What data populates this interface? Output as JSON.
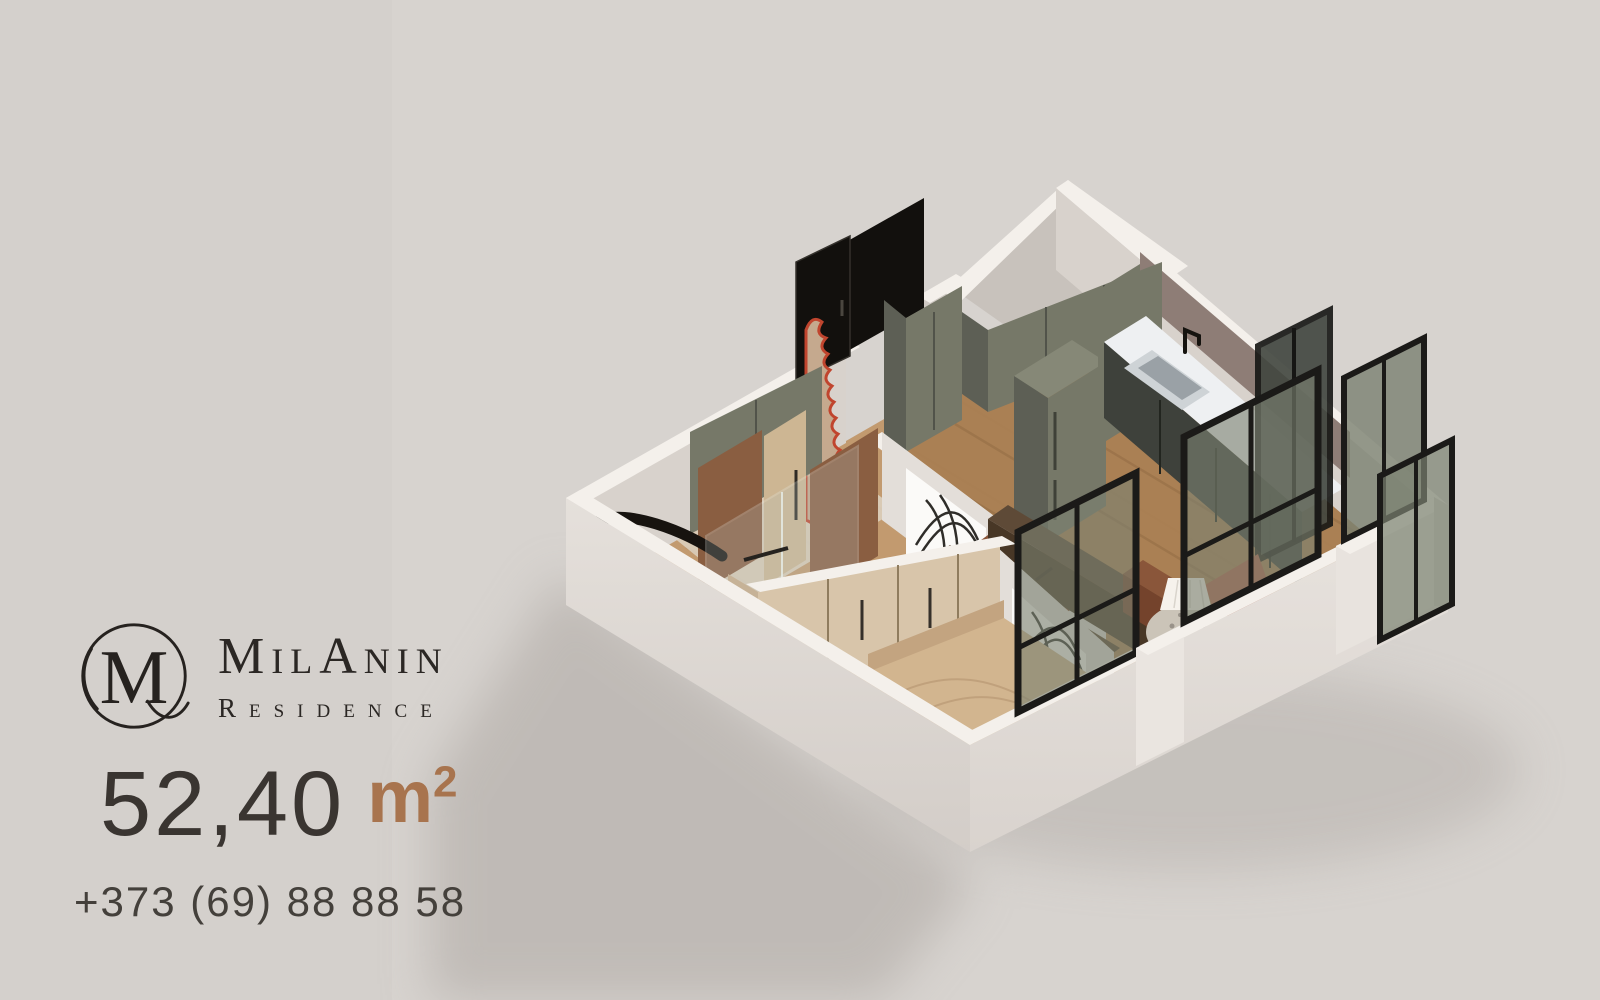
{
  "brand": {
    "logo_letter": "M",
    "name": "MilAnin",
    "subtitle": "Residence"
  },
  "listing": {
    "area_value": "52,40",
    "area_unit_letter": "m",
    "area_unit_sup": "2",
    "phone": "+373 (69) 88 88 58"
  },
  "scene": {
    "type": "isometric-3d-floor-plan",
    "description": "Cutaway 3D isometric render of a 52.40 m2 one-bedroom apartment",
    "rooms": [
      "hallway",
      "bathroom",
      "shower-room",
      "bedroom",
      "living-room",
      "kitchen"
    ],
    "objects": [
      "entrance-door",
      "wavy-mirror",
      "entry-closets",
      "pantry-cabinet",
      "fridge",
      "kitchen-counter-with-sink",
      "botanical-wall-art",
      "tv-console",
      "sofa",
      "floor-lamp",
      "terrazzo-coffee-table",
      "armchair",
      "wardrobe",
      "bed",
      "bathtub",
      "shower-glass",
      "parapet-windows",
      "balcony-windows"
    ]
  },
  "palette": {
    "bg_left": "#d4d0cc",
    "bg_right": "#d7d3cf",
    "shadow": "#a9a39e",
    "wall_top": "#f4f0eb",
    "wall_face": "#e3ded9",
    "wall_face_dark": "#cfc9c3",
    "wall_inner": "#d8d2cc",
    "floor_light": "#c29a6f",
    "floor_dark": "#a87e52",
    "plank_light": "#a37b50",
    "plank_dark": "#8a643f",
    "bath_floor": "#ddd2c2",
    "olive": "#767868",
    "olive_dark": "#5d5f55",
    "olive_light": "#868877",
    "counter_top": "#eef0f2",
    "counter_base": "#3e413b",
    "backsplash": "#8e7d76",
    "sink_steel": "#ced3d6",
    "sink_basin": "#9aa1a6",
    "wood_dark": "#74432c",
    "wood_mid": "#8a563a",
    "sofa": "#57432f",
    "sofa_dark": "#483726",
    "sofa_back": "#5e4a37",
    "table_terrazzo": "#cbc4b8",
    "rust": "#b3614a",
    "wardrobe": "#d8c5aa",
    "wardrobe_side": "#c6b297",
    "bed": "#d2b58f",
    "bed_dark": "#b79877",
    "pillow": "#e3cba6",
    "glass": "#7a8171",
    "glass_dark": "#41463f",
    "frame_black": "#1b1a18",
    "door_black": "#12100d",
    "mirror_red": "#c0452e",
    "mirror_wood": "#c5a98e",
    "art_bg": "#fbfaf8",
    "art_ink": "#1a1713",
    "brown_wall": "#8a5e41",
    "lamp": "#f6f2ec",
    "text_dark": "#2b2724",
    "text_body": "#3a3531",
    "accent": "#a8744e",
    "phone": "#44403b"
  }
}
